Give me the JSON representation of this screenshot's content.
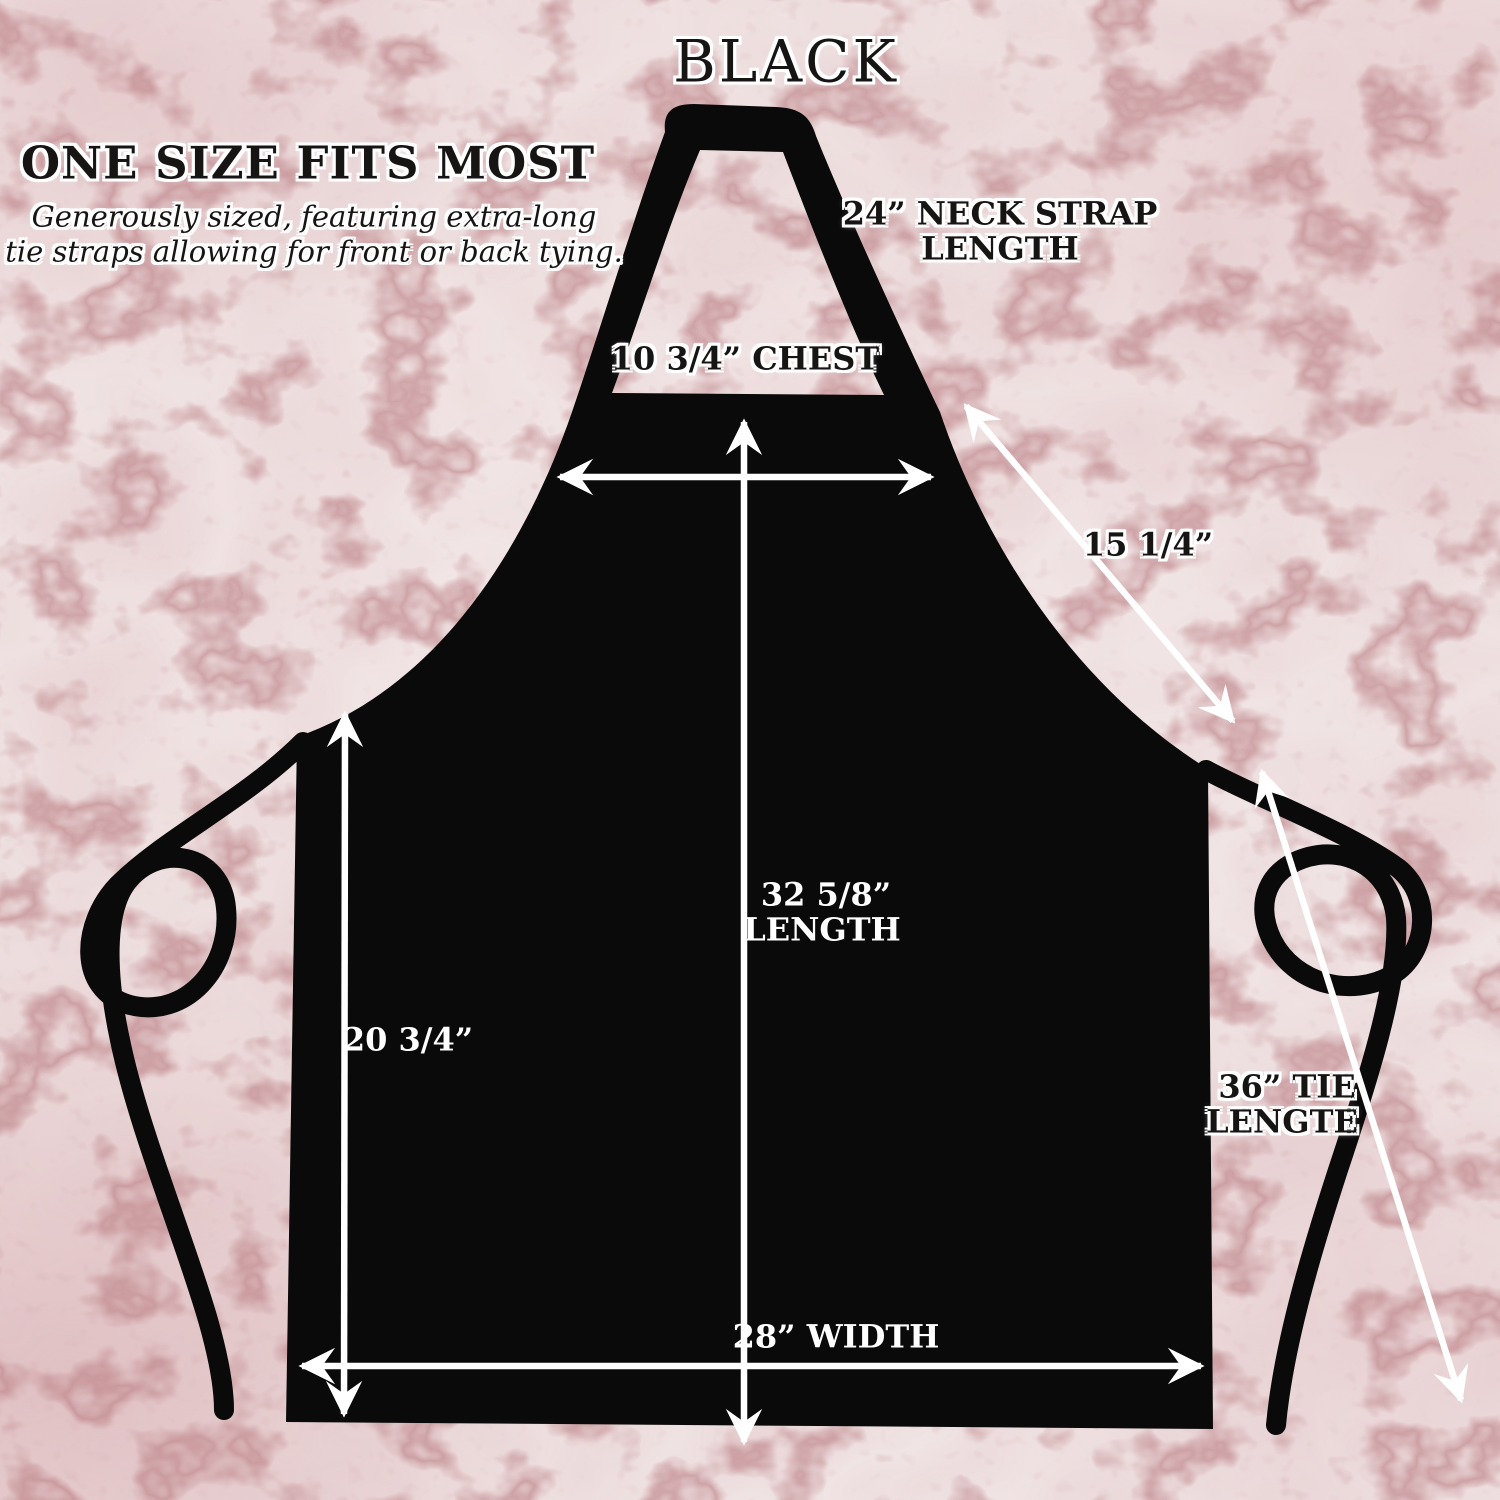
{
  "title": "BLACK",
  "sizing_note": {
    "heading": "ONE SIZE FITS MOST",
    "sub_line1": "Generously sized, featuring extra-long",
    "sub_line2": "tie straps allowing for front or back tying."
  },
  "measurements": {
    "neck_strap_line1": "24” NECK STRAP",
    "neck_strap_line2": "LENGTH",
    "chest": "10 3/4” CHEST",
    "strap_diagonal": "15 1/4”",
    "length_line1": "32 5/8”",
    "length_line2": "LENGTH",
    "side_length": "20 3/4”",
    "tie_line1": "36” TIE",
    "tie_line2": "LENGTE",
    "width": "28” WIDTH"
  },
  "colors": {
    "apron": "#0b0a0a",
    "arrow": "#ffffff",
    "marble_base": "#f1e6e6",
    "marble_vein": "#bc8186",
    "label_dark": "#171514",
    "label_light": "#ffffff"
  }
}
